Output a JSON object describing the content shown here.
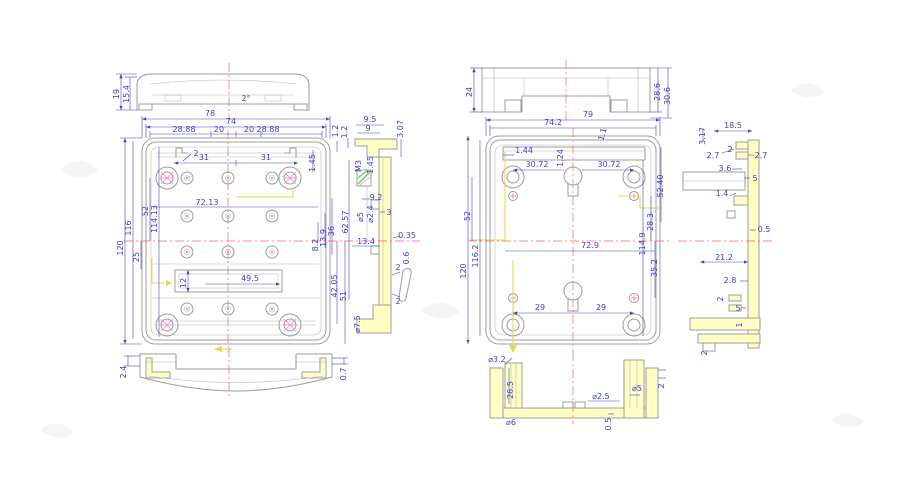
{
  "colors": {
    "dimension_blue": "#4444cc",
    "outline_gray": "#9c9c9c",
    "centerline_red": "#ff6161",
    "section_highlight": "#ffffc4",
    "hatch_pink": "#ff85d6",
    "hatch_green": "#74c474",
    "route_yellow": "#e6d84e"
  },
  "views": {
    "lid_side": {
      "d19": "19",
      "d15_4": "15.4",
      "angle": "2°"
    },
    "lid_plan": {
      "d78": "78",
      "d74": "74",
      "d28_88_l": "28.88",
      "d20_l": "20",
      "d20_r": "20",
      "d28_88_r": "28.88",
      "d2": "2",
      "d31_l": "31",
      "d31_r": "31",
      "d1_2": "1.2",
      "d1_45": "1.45",
      "d120": "120",
      "d116": "116",
      "d52": "52",
      "d114_13": "114.13",
      "d72_13": "72.13",
      "d36": "36",
      "d13_9": "13.9",
      "d8_2": "8.2",
      "d42_05": "42.05",
      "d51": "51",
      "d25": "25",
      "d12": "12",
      "d49_5": "49.5"
    },
    "lid_front": {
      "d2_4": "2.4",
      "d0_7": "0.7"
    },
    "lid_section": {
      "d1_2": "1.2",
      "d9_5": "9.5",
      "d9": "9",
      "d3_07": "3.07",
      "m3": "M3",
      "d1_45": "1.45",
      "d9_2": "9.2",
      "d62_57": "62.57",
      "dia2_4": "⌀2.4",
      "dia5": "⌀5",
      "d3": "3",
      "d13_4": "13.4",
      "d0_35": "0.35",
      "d0_6": "0.6",
      "d2_a": "2",
      "d2_b": "2",
      "dia7_5": "⌀7.5"
    },
    "base_side": {
      "d24": "24",
      "d28_6": "28.6",
      "d30_6": "30.6"
    },
    "base_plan": {
      "d79": "79",
      "d74_2": "74.2",
      "d1_1": "1.1",
      "d1_44": "1.44",
      "d1_24": "1.24",
      "d30_72_l": "30.72",
      "d30_72_r": "30.72",
      "d52_40": "52.40",
      "d28_3": "28.3",
      "d114_9": "114.9",
      "d52": "52",
      "d116_2": "116.2",
      "d120": "120",
      "d72_9": "72.9",
      "d35_2": "35.2",
      "d29_l": "29",
      "d29_r": "29"
    },
    "base_section": {
      "d3_17": "3.17",
      "d18_5": "18.5",
      "d2_7_l": "2.7",
      "d2_a": "2",
      "d2_7_r": "2.7",
      "d3_6": "3.6",
      "d5_a": "5",
      "d1_4": "1.4",
      "d0_5": "0.5",
      "d21_2": "21.2",
      "d2_8": "2.8",
      "d2_b": "2",
      "d5_b": "5",
      "d1": "1",
      "d2_c": "2"
    },
    "base_front_section": {
      "dia3_2": "⌀3.2",
      "d26_5": "26.5",
      "dia6": "⌀6",
      "dia2_5": "⌀2.5",
      "dia5": "⌀5",
      "d0_5": "0.5",
      "d2": "2"
    }
  }
}
